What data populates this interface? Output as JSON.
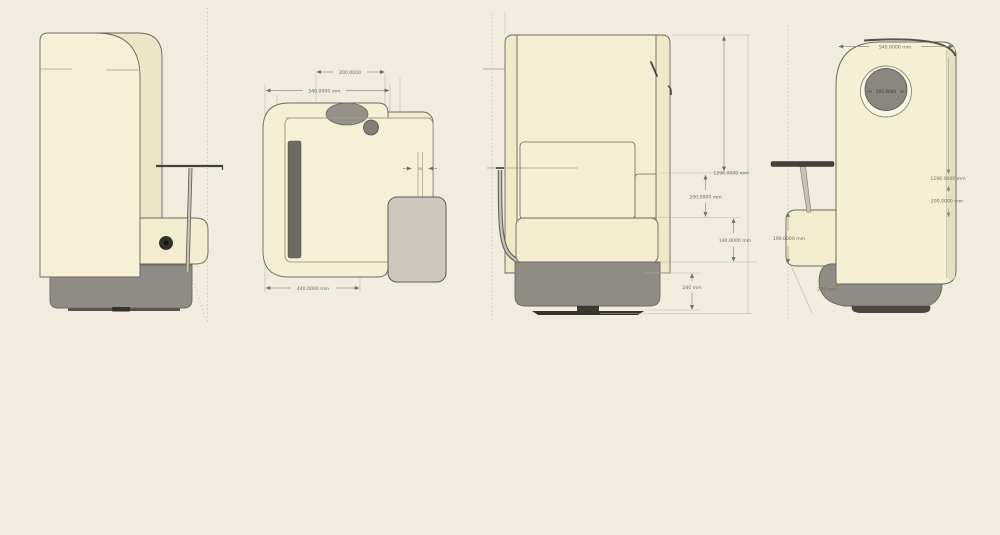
{
  "canvas": {
    "background": "#f2ecdf"
  },
  "colors": {
    "body_cream": "#f5f0d4",
    "body_cream_dark": "#ece6c7",
    "interior_cream": "#f4eed2",
    "panel_cream": "#efe9c8",
    "seat_cream": "#f3edd0",
    "cushion_strip": "#6e6b62",
    "base_gray": "#8f8c85",
    "base_plate_dark": "#3b3934",
    "table_gray": "#cdc8bd",
    "table_edge_dark": "#45423c",
    "porthole_gray": "#8a8780",
    "porthole_ring": "#faf6e6",
    "outline": "#6b6860",
    "dim_line": "#9a9282",
    "dim_text": "#6f6a5d"
  },
  "views": {
    "side": {
      "label": "side view"
    },
    "top": {
      "label": "top view",
      "dims": {
        "headrest_width": "200.0000",
        "shell_width": "540.0000 mm",
        "shell_depth": "440.0000 mm",
        "stem_width": "30"
      }
    },
    "front": {
      "label": "front view",
      "dims": {
        "overall_height": "1296.0000 mm",
        "backrest_height": "200.0000 mm",
        "seat_height": "190.0000 mm",
        "base_height": "240 mm"
      }
    },
    "back": {
      "label": "back view",
      "dims": {
        "shell_width": "540.0000 mm",
        "porthole_diameter": "200.0000",
        "overall_height": "1296.0000 mm",
        "backrest_height": "200.0000 mm",
        "seat_height": "190.0000 mm",
        "base_height": "240 mm"
      }
    }
  }
}
